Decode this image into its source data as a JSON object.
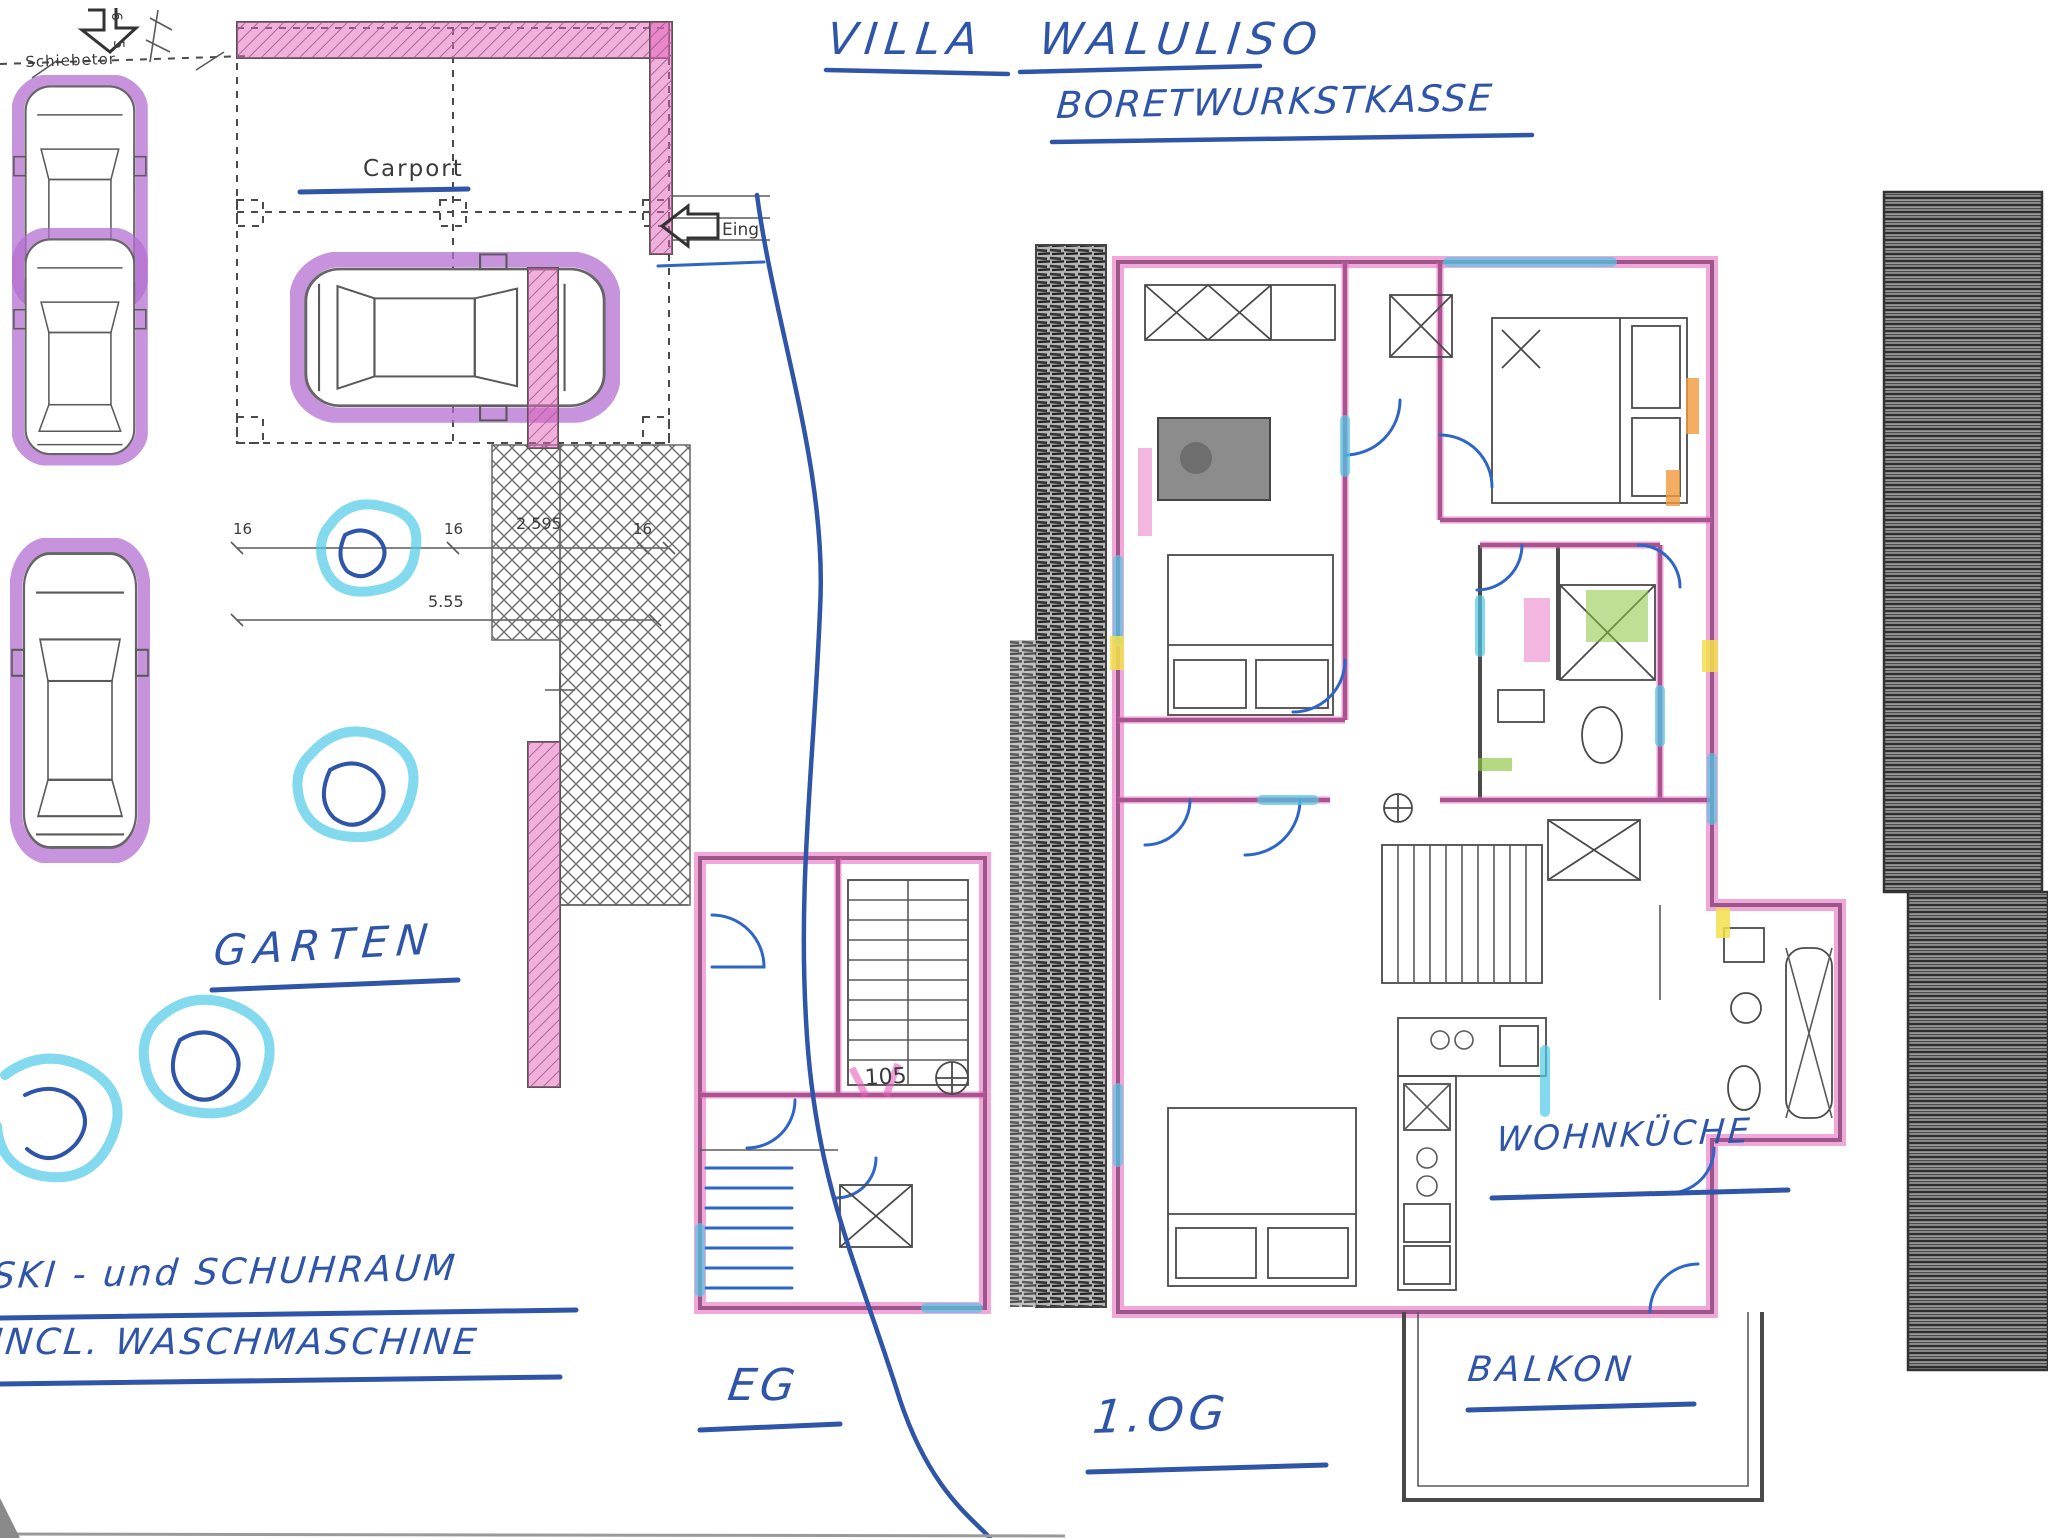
{
  "document": {
    "title_line1": "VILLA WALULISO",
    "title_line2": "BORETWURKSTKASSE"
  },
  "site": {
    "sliding_gate_label": "Schiebetor",
    "carport_label": "Carport",
    "entrance_label": "Eing",
    "garden_label": "GARTEN"
  },
  "ground_floor": {
    "floor_label": "EG",
    "room_number": "105",
    "note_line1": "SKI - und SCHUHRAUM",
    "note_line2": "INCL. WASCHMASCHINE"
  },
  "upper_floor": {
    "floor_label": "1.OG",
    "kitchen_label": "WOHNKÜCHE",
    "balcony_label": "BALKON"
  },
  "dimensions": {
    "row1": [
      "16",
      "16",
      "2.595",
      "16"
    ],
    "row2": "5.55",
    "gate": [
      "6",
      "5"
    ]
  },
  "colors": {
    "ink_blue": "#2f55a8",
    "highlight_magenta": "#e45fb9",
    "highlight_purple": "#b36fd0",
    "highlight_cyan": "#4ec9e6",
    "highlight_green": "#8bc43f",
    "highlight_orange": "#f09a3c",
    "highlight_yellow": "#f2e14c"
  }
}
